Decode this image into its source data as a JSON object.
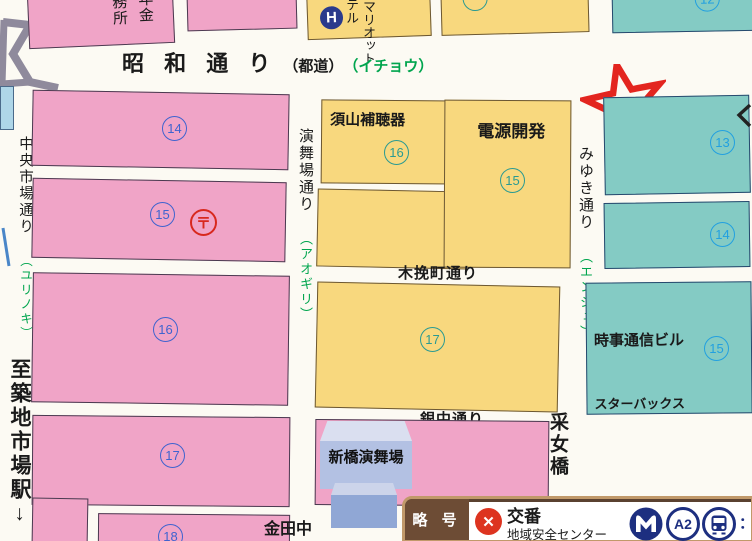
{
  "colors": {
    "block_pink": "#f0a4c7",
    "block_yellow": "#f8d87e",
    "block_teal": "#84cbc4",
    "tree_green": "#00a54e",
    "number_blue": "#3f63cf",
    "number_teal": "#2a9a92",
    "number_cyan": "#22a0e0",
    "annotation_red": "#e3251f",
    "legend_brown": "#6d4c35",
    "transit_navy": "#1d2f80"
  },
  "streets": {
    "showa_name": "昭 和 通 り",
    "showa_type": "（都道）",
    "showa_tree": "（イチョウ）",
    "chuo_name": "中央市場通り",
    "chuo_tree": "（ユリノキ）",
    "embujo_name": "演舞場通り",
    "embujo_tree": "（アオギリ）",
    "miyuki_name": "みゆき通り",
    "miyuki_tree": "（エンジュ）",
    "kobiki_name": "木挽町通り",
    "ginnaka_name": "銀中通り",
    "tsukiji_name": "至築地市場駅↓",
    "uneme_name": "采女橋"
  },
  "blocks": {
    "pink14": "14",
    "pink15": "15",
    "pink16": "16",
    "pink17": "17",
    "pink18": "18",
    "partial_col_right": "年金",
    "partial_col_left": "務所",
    "suyama_label": "須山補聴器",
    "suyama_num": "16",
    "dengen_label": "電源開発",
    "dengen_num": "15",
    "yellow17": "17",
    "teal12": "12",
    "teal13": "13",
    "teal14": "14",
    "jiji_label": "時事通信ビル",
    "jiji_num": "15",
    "jiji_sub": "スターバックス"
  },
  "landmarks": {
    "hotel_icon": "H",
    "hotel_col_left": "テル",
    "hotel_col_right": "マリオット",
    "post_symbol": "〒",
    "shimbashi_embujo": "新橋演舞場",
    "kanetanaka": "金田中"
  },
  "legend": {
    "title": "略 号",
    "koban_symbol": "✕",
    "koban": "交番",
    "anzen_center": "地域安全センター",
    "exit_label": "A2",
    "colon": "："
  }
}
